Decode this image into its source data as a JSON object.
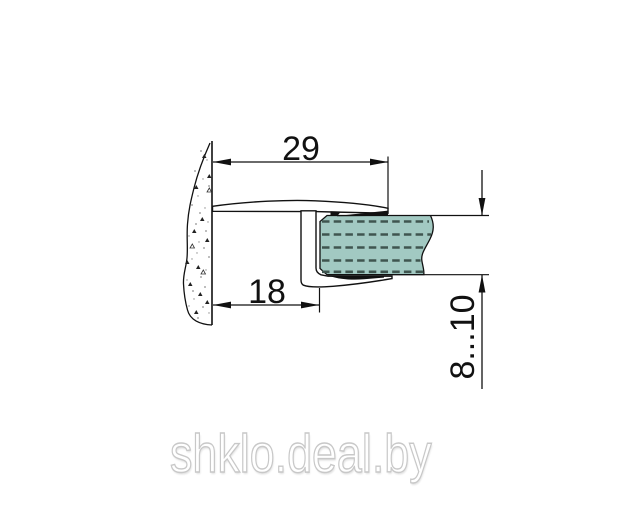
{
  "diagram": {
    "title": "seal-profile-cross-section",
    "dimensions": {
      "profile_width": "29",
      "wall_to_glass": "18",
      "glass_thickness": "8...10"
    },
    "watermark": "shklo.deal.by",
    "colors": {
      "line": "#111111",
      "glass_fill": "#a2c9c2",
      "glass_dash": "#3f554f",
      "watermark_stroke": "#c8c8c8"
    }
  }
}
